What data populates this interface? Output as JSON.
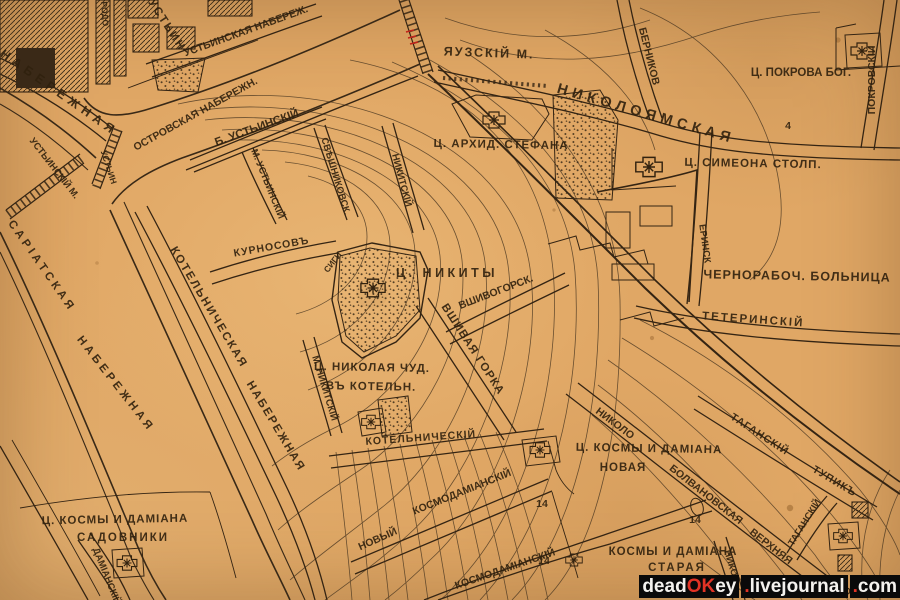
{
  "map": {
    "colors": {
      "paper": "#e0a765",
      "ink": "#32220f",
      "red_mark": "#c1231a"
    },
    "labels": {
      "naberezhnaya": "НАБЕРЕЖНАЯ",
      "ustinskaya_nab": "УСТЬИНСКАЯ НАБЕРЕЖ.",
      "ustin_top": "УСТЬИН",
      "ust_corner": "УСТЬ",
      "rodo": "РОДО",
      "ostrovskaya": "ОСТРОВСКАЯ НАБЕРЕЖН.",
      "b_ustinsky": "Б. УСТЬИНСКІЙ",
      "m_ustinsky": "М. УСТЬИНСКІЙ",
      "ustinsky_most": "УСТЬИНСКІЙ М.",
      "ustin2": "УСТЬИН",
      "yauzsky_most": "ЯУЗСКІЙ М.",
      "sariatskaya": "САРІАТСКАЯ",
      "sariat_nab": "НАБЕРЕЖНАЯ",
      "kotel_nab1": "КОТЕЛЬНИЧЕСКАЯ",
      "kotel_nab2": "НАБЕРЕЖНАЯ",
      "stefana": "Ц. АРХИД. СТЕФАНА",
      "nikoloyamskaya": "НИКОЛОЯМСКАЯ",
      "pokrova": "Ц. ПОКРОВА БОГ.",
      "pokrovsky": "ПОКРОВСКІЙ",
      "simeona": "Ц. СИМЕОНА СТОЛП.",
      "bernikov": "БЕРНИКОВ",
      "chernorab": "ЧЕРНОРАБОЧ. БОЛЬНИЦА",
      "teterinsky": "ТЕТЕРИНСКІЙ",
      "terinsk": "ЕРИНСК",
      "kurnosov": "КУРНОСОВЪ",
      "sveshnikovsk": "СВѢШНИКОВСК.",
      "nikitsky": "НИКИТСКІЙ",
      "m_nikitsky": "М. НИКИТСКІЙ",
      "sigi": "СИГИ",
      "nikity": "Ц. НИКИТЫ",
      "vshivogorsk": "ВШИВОГОРСК.",
      "vshivaya": "ВШИВАЯ ГОРКА",
      "nikolaya1": "Ц. НИКОЛАЯ ЧУД.",
      "nikolaya2": "ВЪ КОТЕЛЬН.",
      "kotelnichesky": "КОТЕЛЬНИЧЕСКІЙ",
      "novy": "НОВЫЙ",
      "kosmo1": "КОСМОДАМІАНСКІЙ",
      "kosmo2": "КОСМОДАМІАНСКІЙ",
      "kosmy_nov1": "Ц. КОСМЫ И ДАМІАНА",
      "kosmy_nov2": "НОВАЯ",
      "kosmy_star1": "КОСМЫ И ДАМІАНА",
      "kosmy_star2": "СТАРАЯ",
      "sadovniki1": "Ц. КОСМЫ И ДАМІАНА",
      "sadovniki2": "САДОВНИКИ",
      "damiansky": "ДАМІАНСКІЙ",
      "tagansky": "ТАГАНСКІЙ",
      "tupik": "ТУПИКЪ",
      "tagansky_v": "ТАГАНСКІЙ",
      "nikolo": "НИКОЛО",
      "bolvanovskaya": "БОЛВАНОВСКАЯ",
      "verkhnyaya": "ВЕРХНЯЯ",
      "niko_v": "НИКОЛ",
      "na_bolvanov": "НА БОЛВАНОВ",
      "num4": "4",
      "num14a": "14",
      "num14b": "14",
      "num14c": "14"
    }
  },
  "watermark": {
    "p1": "dead",
    "p2": "OK",
    "p3": "ey",
    "d1": ".",
    "p4": "livejournal",
    "d2": ".",
    "p5": "com"
  }
}
